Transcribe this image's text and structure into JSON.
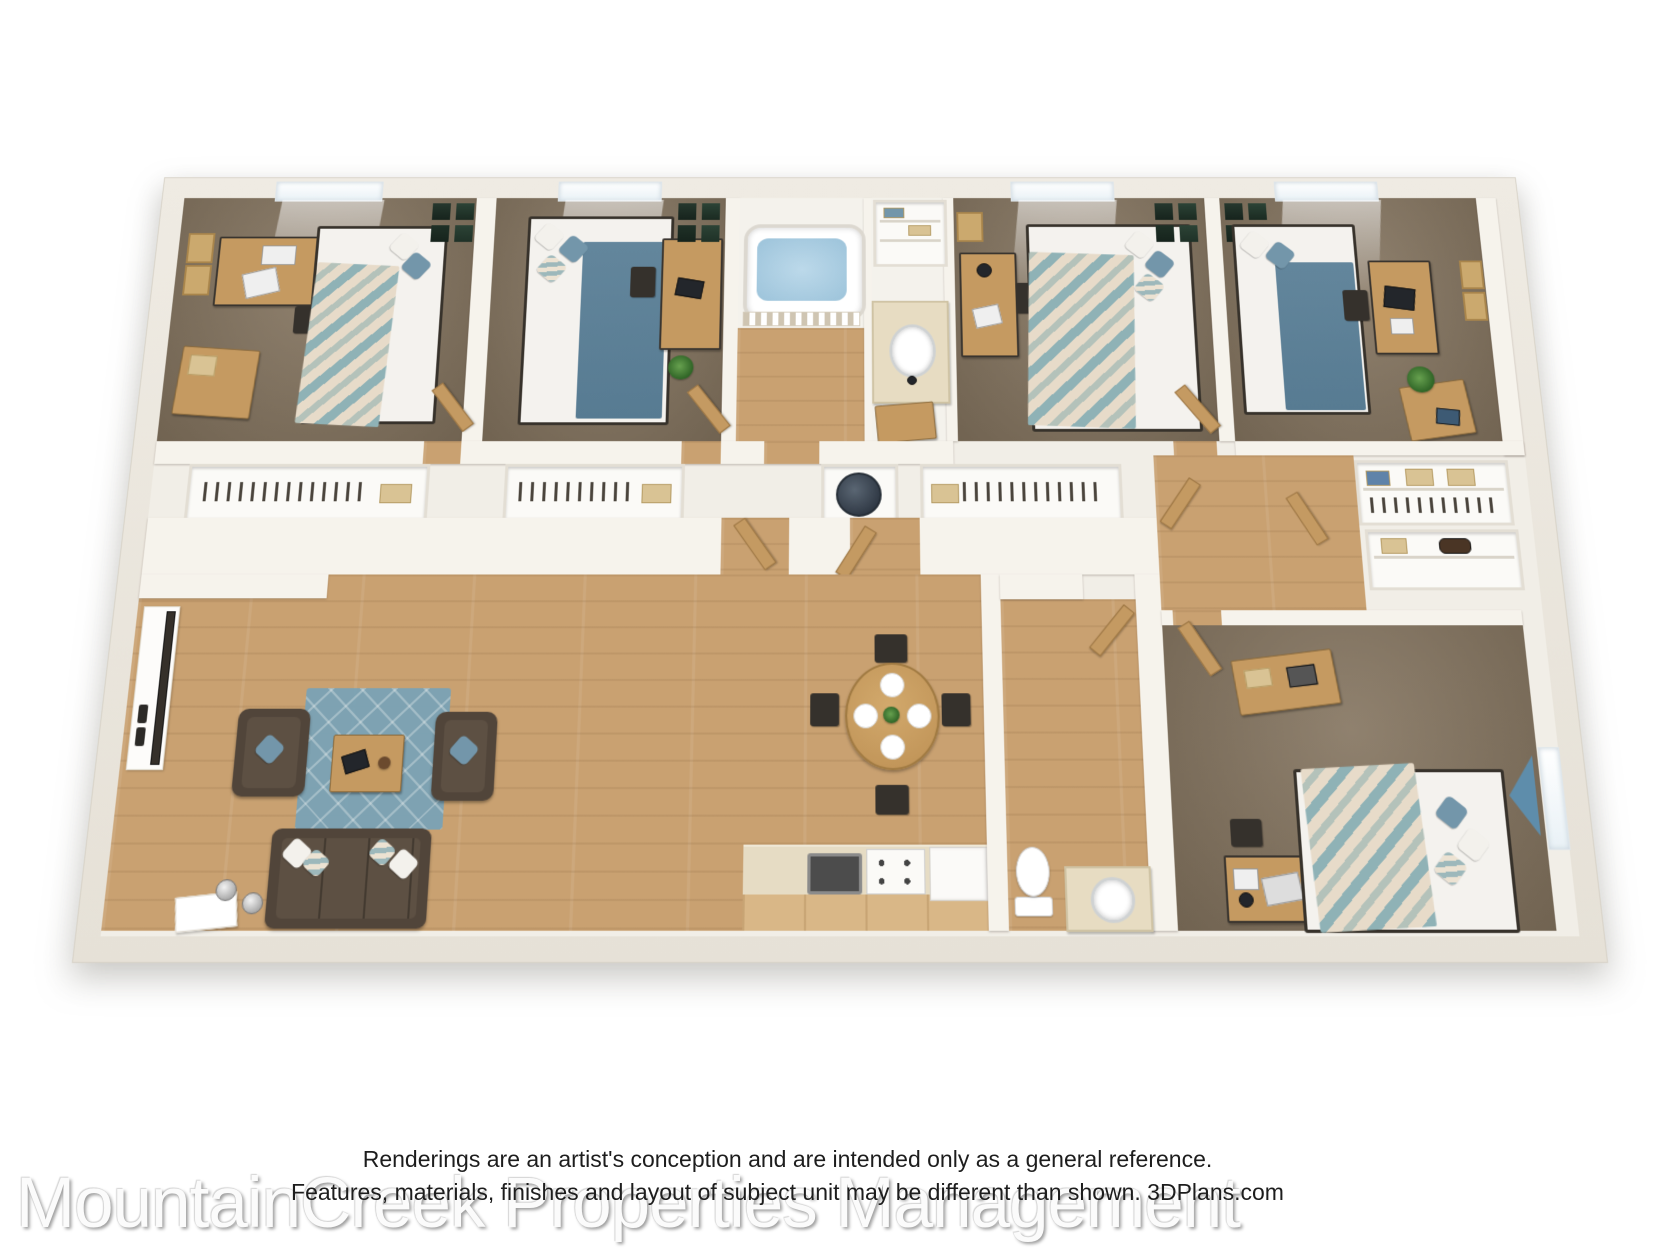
{
  "watermark": {
    "text": "MountainCreek Properties Management"
  },
  "disclaimer": {
    "line1": "Renderings are an artist's conception and are intended only as a general reference.",
    "line2": "Features, materials, finishes and layout of subject unit may be different than shown. 3DPlans.com"
  },
  "palette": {
    "background": "#ffffff",
    "wall": "#f6f3ec",
    "carpet": "#83735e",
    "wood_floor": "#c9a171",
    "rug_blue": "#7aa3b6",
    "sofa_brown": "#51453a",
    "bed_blanket_blue": "#5f8399",
    "bedding_teal": "#8fb2b6",
    "desk_wood": "#c59a61",
    "tub_water": "#a9cde0"
  },
  "floorplan": {
    "type": "3d-rendered-floor-plan",
    "rooms": [
      {
        "name": "bedroom-1",
        "floor": "carpet",
        "furniture": [
          "bed",
          "desk",
          "chair",
          "dresser",
          "corkboards",
          "picture-frames",
          "closet",
          "window"
        ]
      },
      {
        "name": "bedroom-2",
        "floor": "carpet",
        "furniture": [
          "bed",
          "desk",
          "chair",
          "plant",
          "picture-frames",
          "closet",
          "window"
        ]
      },
      {
        "name": "bathroom-1",
        "floor": "wood",
        "furniture": [
          "bathtub",
          "shower-curtain",
          "vanity-sink",
          "linen-closet",
          "water-heater"
        ]
      },
      {
        "name": "bedroom-3",
        "floor": "carpet",
        "furniture": [
          "bed",
          "desk",
          "chair",
          "corkboards",
          "picture-frames",
          "closet",
          "window"
        ]
      },
      {
        "name": "bedroom-4",
        "floor": "carpet",
        "furniture": [
          "bed",
          "desk",
          "computer",
          "chair",
          "dresser",
          "plant",
          "corkboards",
          "picture-frames",
          "closet",
          "window"
        ]
      },
      {
        "name": "living-room",
        "floor": "wood",
        "furniture": [
          "sofa",
          "armchair",
          "armchair",
          "coffee-table",
          "area-rug",
          "floor-lamps",
          "console-table",
          "shoe-cabinet"
        ]
      },
      {
        "name": "dining-area",
        "floor": "wood",
        "furniture": [
          "round-table",
          "four-chairs",
          "four-plates",
          "centerpiece"
        ]
      },
      {
        "name": "kitchen",
        "floor": "wood",
        "furniture": [
          "counter",
          "sink",
          "stove",
          "refrigerator"
        ]
      },
      {
        "name": "bathroom-2",
        "floor": "wood",
        "furniture": [
          "toilet",
          "vanity-sink",
          "door"
        ]
      },
      {
        "name": "bedroom-5",
        "floor": "carpet",
        "furniture": [
          "bed",
          "desk",
          "laptop",
          "chair",
          "dresser",
          "closet",
          "window",
          "curtain"
        ]
      },
      {
        "name": "hallway",
        "floor": "wood",
        "furniture": [
          "doors"
        ]
      }
    ]
  }
}
